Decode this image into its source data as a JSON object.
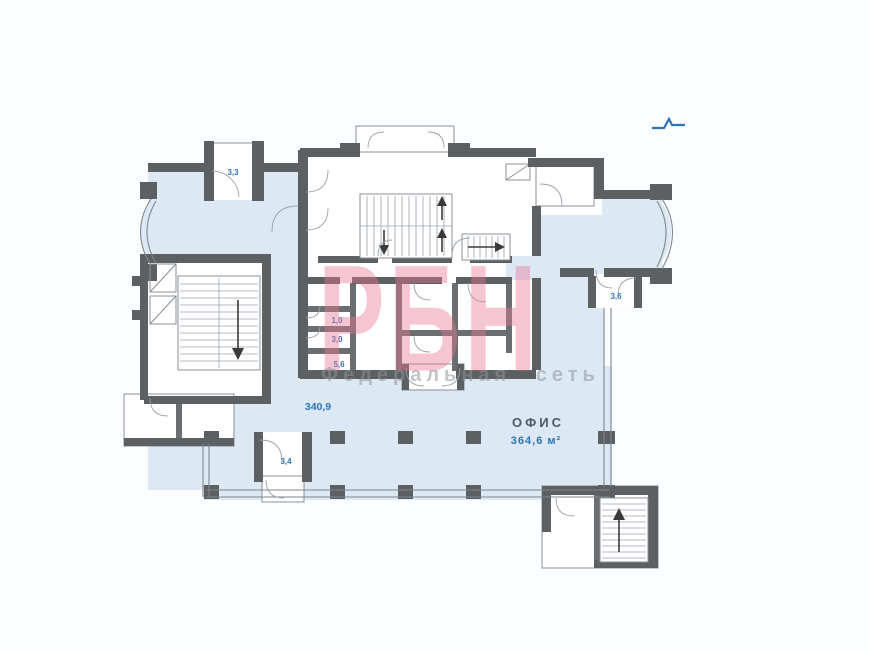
{
  "page": {
    "background": "#fcfdfe"
  },
  "watermark": {
    "brand": "РБН",
    "tagline": "Федеральная сеть",
    "brand_color": "#e77694",
    "tagline_color": "#8e949a"
  },
  "compass": {
    "icon": "north-indicator",
    "color": "#2f74b5"
  },
  "plan": {
    "colors": {
      "floor": "#dce8f4",
      "wall": "#5d6063",
      "room": "#ffffff",
      "label": "#2e74b6",
      "office_title": "#4b5a6a"
    },
    "office": {
      "title": "ОФИС",
      "area": "364,6 м²"
    },
    "zone_area": "340,9",
    "rooms": {
      "balcony_top_left": "3,3",
      "vestibule_right": "3,6",
      "wc_small": "1,0",
      "wc": "3,0",
      "hall_small": "5,6",
      "entrance_vestibule": "3,4"
    }
  }
}
